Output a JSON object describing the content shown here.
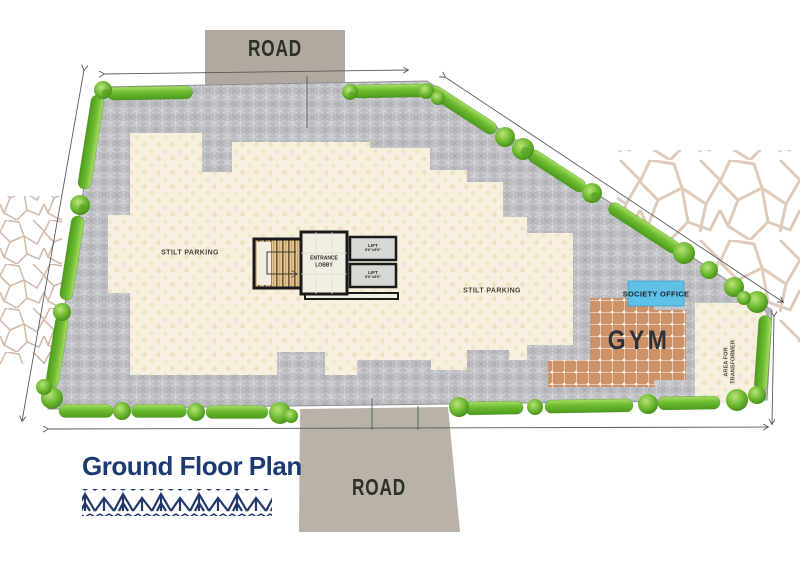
{
  "plan": {
    "title": "Ground Floor Plan",
    "road_top_label": "ROAD",
    "road_bottom_label": "ROAD",
    "stilt_parking_left": "STILT PARKING",
    "stilt_parking_right": "STILT PARKING",
    "entrance_lobby": "ENTRANCE LOBBY",
    "lift_top": {
      "name": "LIFT",
      "size": "5'0\"x5'0\""
    },
    "lift_bottom": {
      "name": "LIFT",
      "size": "5'0\"x5'0\""
    },
    "society_office": "SOCIETY OFFICE",
    "gym": "GYM",
    "transformer_area": "AREA FOR TRANSFORMER"
  },
  "colors": {
    "pavement": "#bcbdc0",
    "building_fill": "#f7f0df",
    "gym_tiles": "#cd9267",
    "society_office_blue": "#5fc0e8",
    "hedge_green": "#5aa824",
    "road_gray": "#b1a9a0",
    "title_navy": "#1d3a70"
  }
}
